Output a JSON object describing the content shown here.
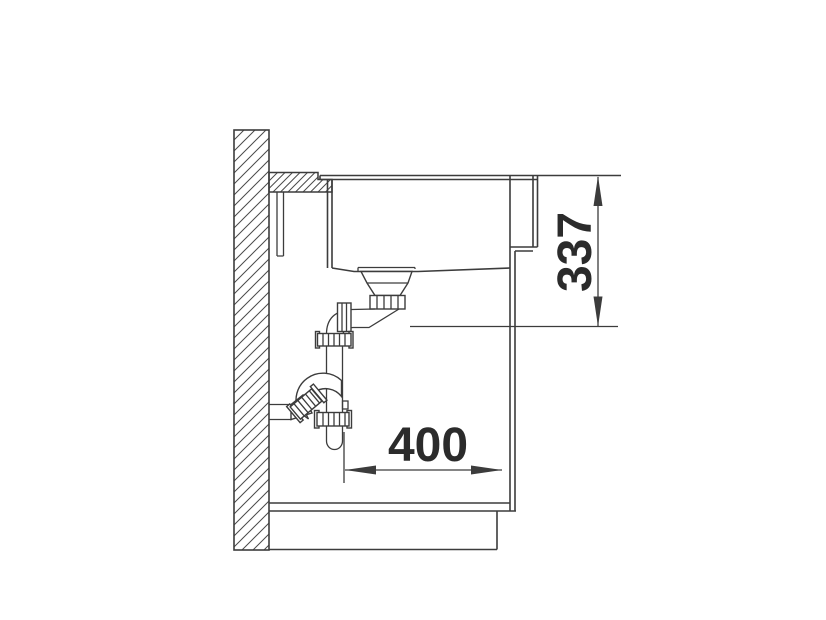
{
  "diagram": {
    "type": "sink-installation-side-section",
    "dimension_vertical": "337",
    "dimension_horizontal": "400",
    "line_color": "#3c3c3c",
    "text_color": "#2b2b2b",
    "background_color": "#ffffff"
  }
}
